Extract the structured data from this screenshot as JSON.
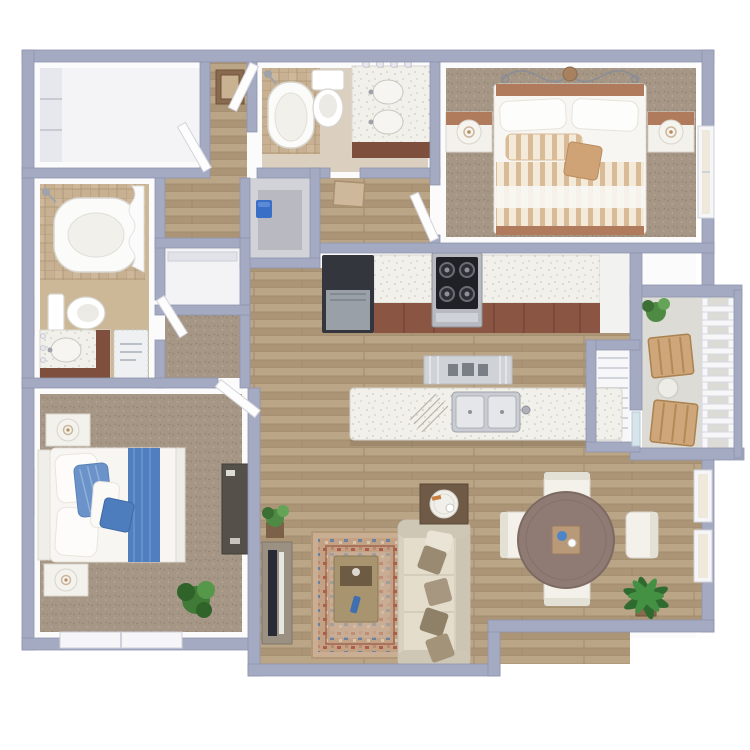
{
  "meta": {
    "type": "3d-floor-plan",
    "description": "Top-down 3D rendering of a two bedroom, two bathroom apartment floor plan with balcony"
  },
  "colors": {
    "wall": "#a5aac3",
    "wall_edge": "#8f94ae",
    "wood": "#b49d80",
    "carpet": "#a69685",
    "tile": "#c8b193",
    "counter": "#f1f0ea",
    "cabinet": "#8a5643",
    "fridge": "#33363c",
    "sofa": "#d9d1c0",
    "throw_pillow": "#9a8a72",
    "rug": "#c9ae93",
    "bed_accent_blue": "#4f7fbf",
    "headboard_copper": "#b07a5c",
    "dining_table": "#8f7b73",
    "plant_green": "#4f8a44",
    "balcony_floor": "#dcdbd6",
    "patio_chair_wood": "#cfa679"
  },
  "rooms": [
    {
      "id": "walk-in-closet",
      "items": [
        "shelving-unit"
      ]
    },
    {
      "id": "hallway",
      "items": [
        "entry-mat",
        "open-doors",
        "door-mat"
      ]
    },
    {
      "id": "bathroom-1",
      "items": [
        "bathtub",
        "shower-head",
        "toilet",
        "double-vanity",
        "vanity-lights"
      ]
    },
    {
      "id": "utility-closet",
      "items": [
        "water-heater"
      ]
    },
    {
      "id": "bedroom-1",
      "items": [
        "bed",
        "headboard-scroll-art",
        "nightstand-left",
        "nightstand-right",
        "table-lamps",
        "window"
      ]
    },
    {
      "id": "bathroom-2",
      "items": [
        "bathtub",
        "shower-curtain",
        "shower-head",
        "toilet",
        "vanity",
        "bath-mat",
        "wall-art"
      ]
    },
    {
      "id": "linen-closet",
      "items": [
        "shelf"
      ]
    },
    {
      "id": "bedroom-2-closet",
      "items": [
        "carpet-floor"
      ]
    },
    {
      "id": "kitchen",
      "items": [
        "refrigerator",
        "range",
        "countertop",
        "cabinets",
        "island",
        "double-sink",
        "faucet",
        "dish-rack",
        "runner-mat"
      ]
    },
    {
      "id": "pantry-nook",
      "items": []
    },
    {
      "id": "mechanical-closet",
      "items": [
        "louvered-door"
      ]
    },
    {
      "id": "balcony",
      "items": [
        "railing",
        "patio-chair-top",
        "patio-chair-bottom",
        "side-table",
        "potted-plant"
      ]
    },
    {
      "id": "bedroom-2",
      "items": [
        "bed-blue-bedding",
        "nightstand-top",
        "nightstand-bottom",
        "table-lamps",
        "dresser",
        "potted-plant",
        "window",
        "wall-art"
      ]
    },
    {
      "id": "living-room",
      "items": [
        "sofa",
        "throw-pillows",
        "area-rug",
        "coffee-table",
        "end-table",
        "tv-console",
        "tv",
        "potted-plant"
      ]
    },
    {
      "id": "dining-room",
      "items": [
        "round-table",
        "dining-chairs",
        "centerpiece",
        "palm-plant",
        "windows"
      ]
    }
  ]
}
